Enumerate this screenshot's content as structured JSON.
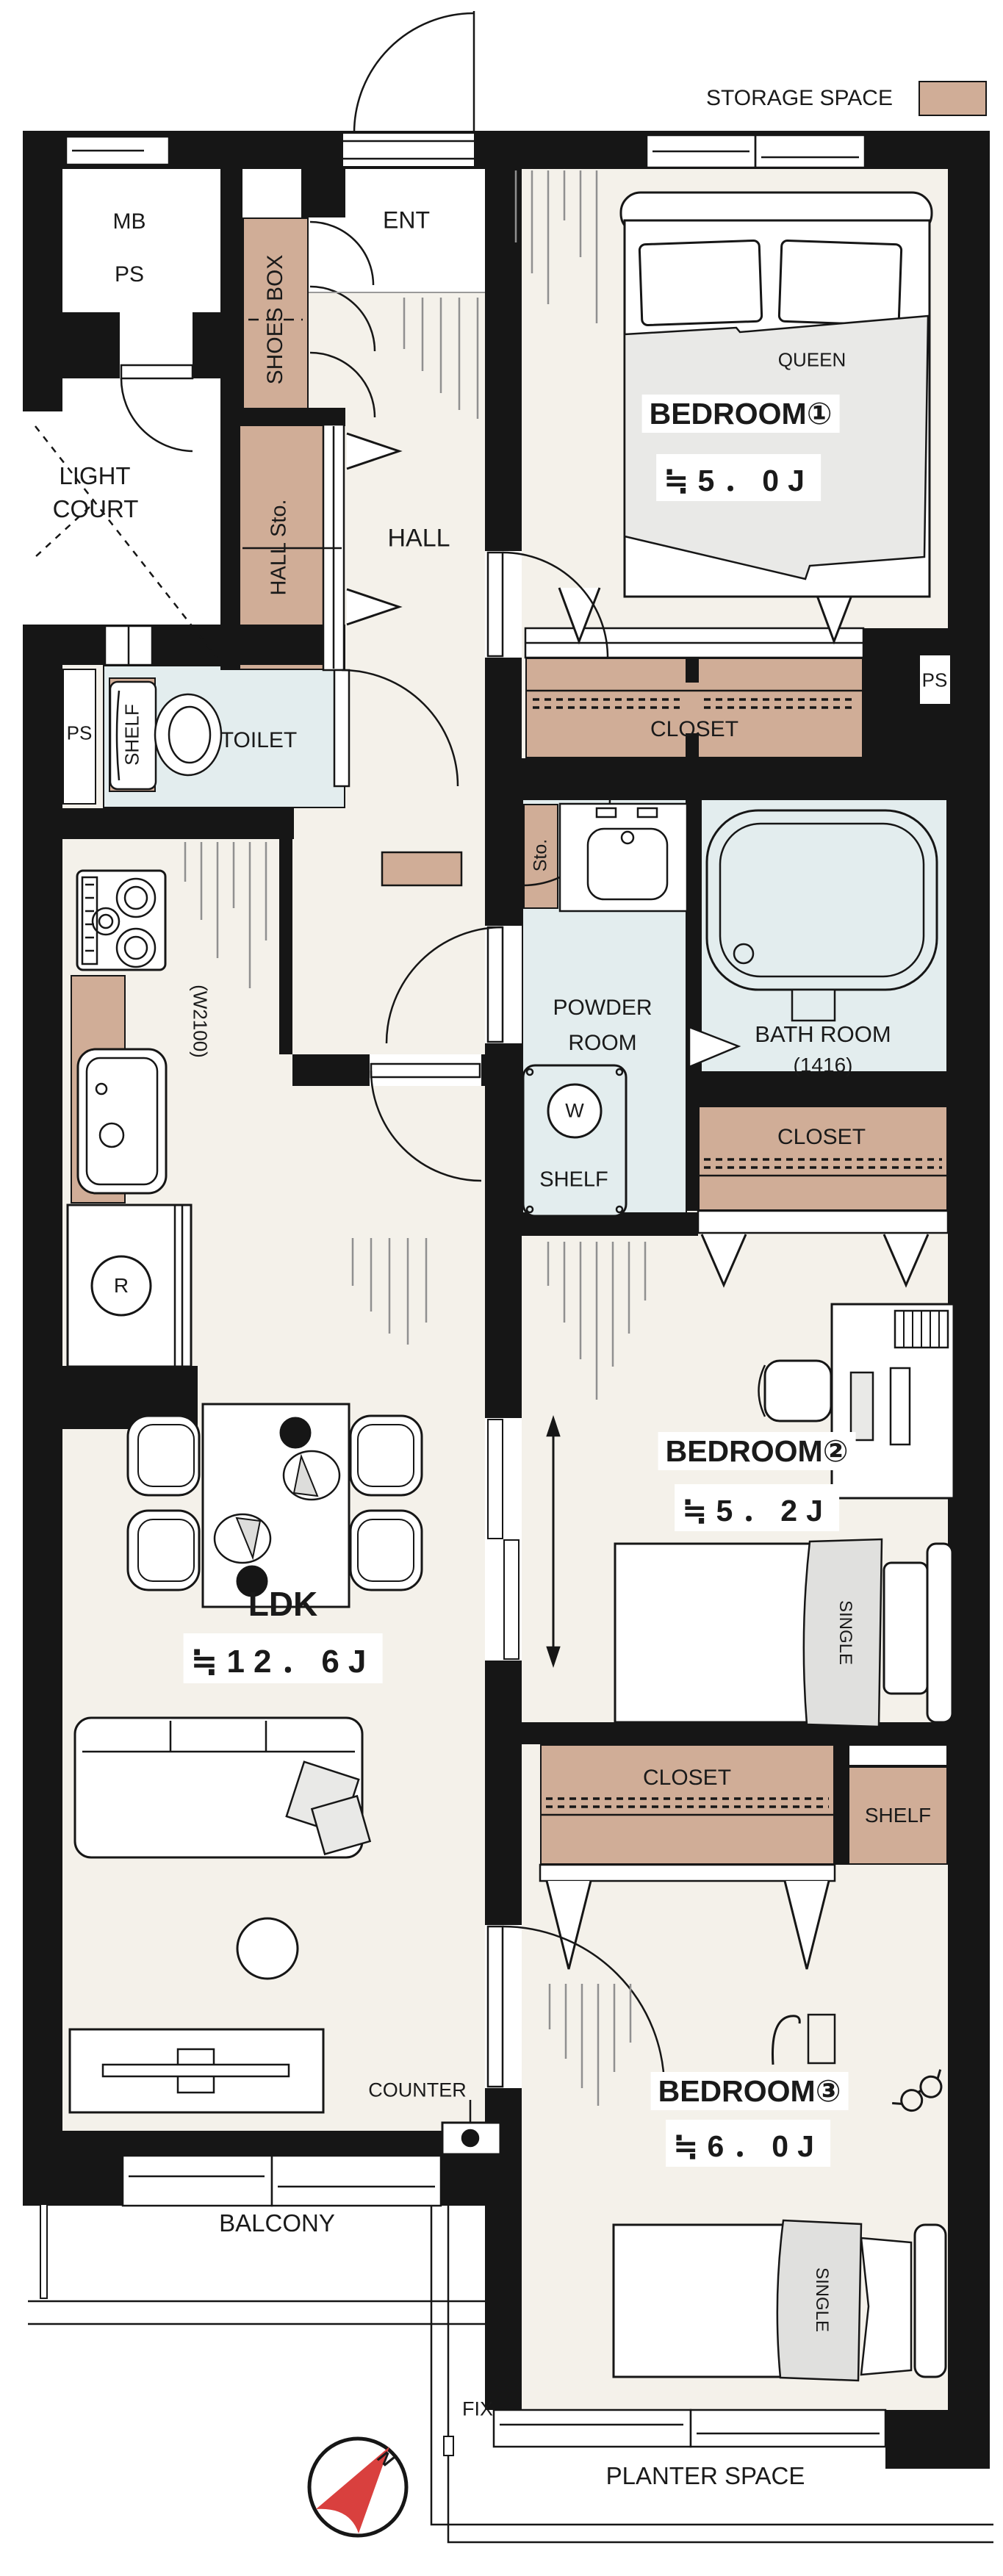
{
  "legend": {
    "label": "STORAGE SPACE"
  },
  "colors": {
    "storage_tan": "#d0ad97",
    "wet_area_blue": "#e3edee",
    "floor": "#f4f1ea",
    "wall_black": "#161616",
    "hatch_gray": "#909090",
    "blanket_gray": "#e9e9e7",
    "compass_red": "#d9403e"
  },
  "rooms": {
    "mb": "MB",
    "ps": "PS",
    "ent": "ENT",
    "shoes_box": "SHOES BOX",
    "light_court": [
      "LIGHT",
      "COURT"
    ],
    "hall": "HALL",
    "hall_sto": "HALL Sto.",
    "ps_left": "PS",
    "toilet": "TOILET",
    "toilet_shelf": "SHELF",
    "bedroom1": {
      "name": "BEDROOM①",
      "size": "≒5．0J",
      "bed": "QUEEN"
    },
    "closet1": "CLOSET",
    "ps_right": "PS",
    "sto": "Sto.",
    "powder": [
      "POWDER",
      "ROOM"
    ],
    "bath": {
      "name": "BATH ROOM",
      "size": "(1416)"
    },
    "washer": "W",
    "powder_shelf": "SHELF",
    "closet2": "CLOSET",
    "kitchen": {
      "width": "(W2100)",
      "fridge": "R"
    },
    "ldk": {
      "name": "LDK",
      "size": "≒12．6J"
    },
    "bedroom2": {
      "name": "BEDROOM②",
      "size": "≒5．2J",
      "bed": "SINGLE"
    },
    "closet3": "CLOSET",
    "shelf3": "SHELF",
    "counter": "COUNTER",
    "bedroom3": {
      "name": "BEDROOM③",
      "size": "≒6．0J",
      "bed": "SINGLE"
    },
    "balcony": "BALCONY",
    "fix": "FIX",
    "planter": "PLANTER SPACE",
    "compass_north": "N"
  }
}
